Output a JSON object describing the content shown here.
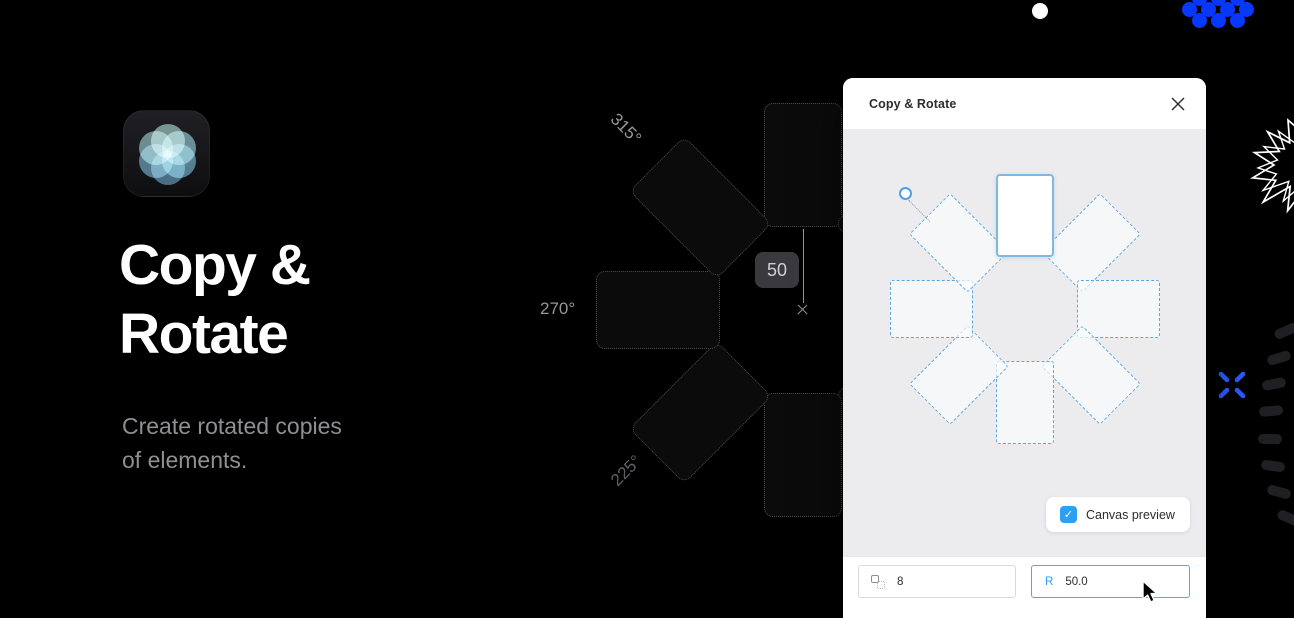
{
  "hero": {
    "title_line1": "Copy &",
    "title_line2": "Rotate",
    "subtitle_line1": "Create rotated copies",
    "subtitle_line2": "of elements."
  },
  "canvas": {
    "angle_labels": [
      "315°",
      "270°",
      "225°"
    ],
    "radius_badge": "50"
  },
  "modal": {
    "title": "Copy & Rotate",
    "canvas_preview_label": "Canvas preview",
    "checkbox_check": "✓",
    "copies_input": {
      "value": "8"
    },
    "radius_input": {
      "prefix": "R",
      "value": "50.0"
    }
  },
  "colors": {
    "background": "#000000",
    "accent_blue": "#2f9ff4",
    "preview_dash_blue": "#5ca5e0",
    "deco_blue": "#0838ff",
    "subtitle_gray": "#8f8f94",
    "badge_bg": "#3a3a3e"
  }
}
